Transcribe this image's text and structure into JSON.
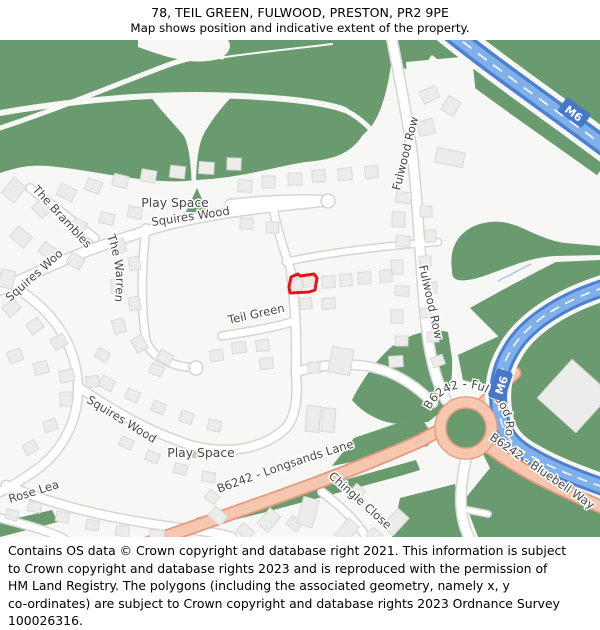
{
  "header": {
    "title": "78, TEIL GREEN, FULWOOD, PRESTON, PR2 9PE",
    "subtitle": "Map shows position and indicative extent of the property."
  },
  "footer": {
    "lines": [
      "Contains OS data © Crown copyright and database right 2021. This information is subject",
      "to Crown copyright and database rights 2023 and is reproduced with the permission of",
      "HM Land Registry. The polygons (including the associated geometry, namely x, y",
      "co-ordinates) are subject to Crown copyright and database rights 2023 Ordnance Survey",
      "100026316."
    ]
  },
  "map": {
    "labels": {
      "play_space_1": "Play Space",
      "play_space_2": "Play Space",
      "squires_wood_1": "Squires Wood",
      "squires_wood_2": "Squires Wood",
      "squires_wood_3": "Squires Wood",
      "the_brambles": "The Brambles",
      "the_warren": "The Warren",
      "fulwood_row_1": "Fulwood Row",
      "fulwood_row_2": "Fulwood Row",
      "teil_green": "Teil Green",
      "rose_lea": "Rose Lea",
      "chingle_close": "Chingle Close",
      "b6242_longsands": "B6242 - Longsands Lane",
      "b6242_fulwood_row": "B6242 - Fulwood Row",
      "b6242_bluebell": "B6242 - Bluebell Way",
      "m6_top": "M6",
      "m6_bottom": "M6"
    },
    "property": {
      "polygon_points": "289,247 291,237 298,234 300,236 314,234 317,238 316,244 315,250 309,252 290,253"
    },
    "palette": {
      "map-bg": "#f7f7f6",
      "green": "#699b6e",
      "playspace-marker": "#b9d2b9",
      "building": "#ececeb",
      "building-stroke": "#d9d9d8",
      "road": "#ffffff",
      "road-casing": "#d5d5d4",
      "aroad": "#f7c6ae",
      "aroad-casing": "#e29a7d",
      "m6": "#7fb0ea",
      "m6-dark": "#4e80d2",
      "m6-ref-bg": "#4677cb",
      "stream": "#a8c8e8",
      "label": "#474747",
      "property-outline": "#ee1111"
    }
  }
}
